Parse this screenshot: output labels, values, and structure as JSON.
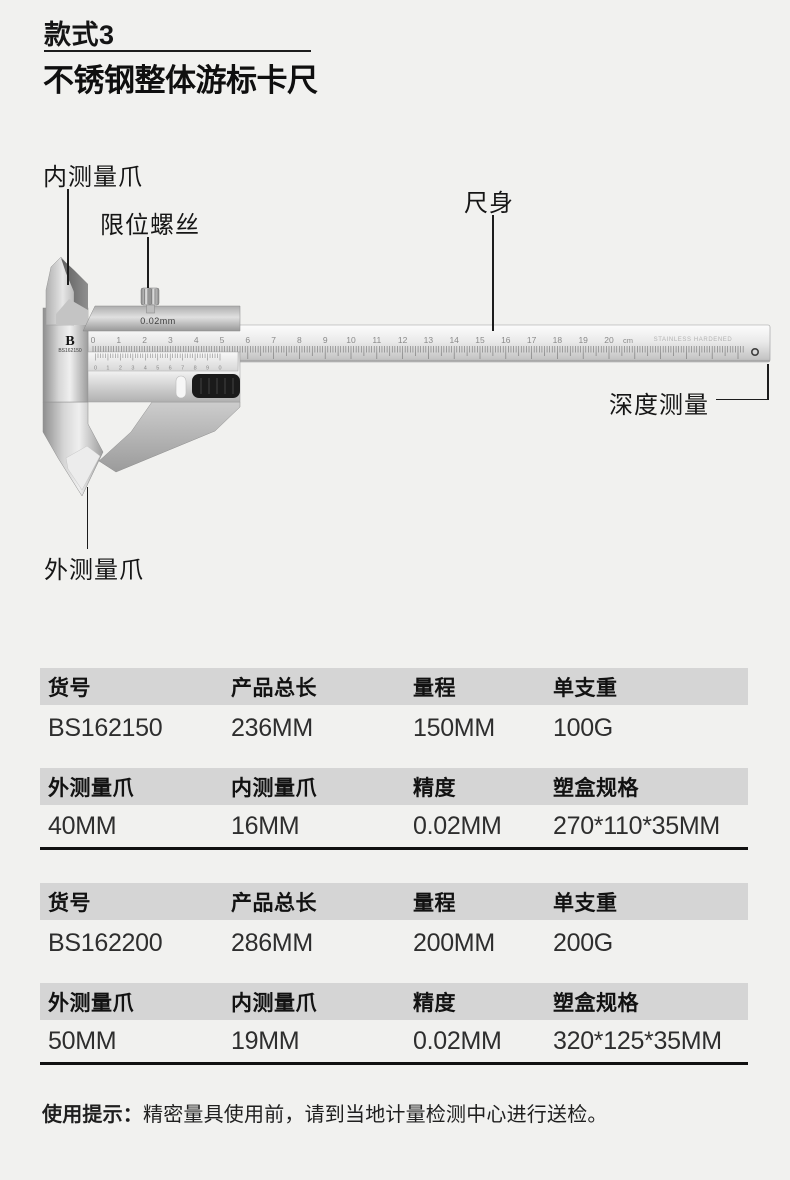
{
  "header": {
    "style_label": "款式3",
    "title": "不锈钢整体游标卡尺"
  },
  "diagram": {
    "callouts": [
      {
        "id": "inner-jaw",
        "label": "内测量爪"
      },
      {
        "id": "limit-screw",
        "label": "限位螺丝"
      },
      {
        "id": "beam",
        "label": "尺身"
      },
      {
        "id": "depth",
        "label": "深度测量"
      },
      {
        "id": "outer-jaw",
        "label": "外测量爪"
      }
    ],
    "caliper": {
      "vernier_label": "0.02mm",
      "logo": "B",
      "model": "BS162150",
      "scale_min": 0,
      "scale_max": 20,
      "scale_unit": "cm",
      "engraving": "STAINLESS  HARDENED",
      "vernier_digits": [
        "0",
        "1",
        "2",
        "3",
        "4",
        "5",
        "6",
        "7",
        "8",
        "9",
        "0"
      ]
    }
  },
  "tables": [
    {
      "sections": [
        {
          "headers": [
            "货号",
            "产品总长",
            "量程",
            "单支重"
          ],
          "values": [
            "BS162150",
            "236MM",
            "150MM",
            "100G"
          ]
        },
        {
          "headers": [
            "外测量爪",
            "内测量爪",
            "精度",
            "塑盒规格"
          ],
          "values": [
            "40MM",
            "16MM",
            "0.02MM",
            "270*110*35MM"
          ]
        }
      ]
    },
    {
      "sections": [
        {
          "headers": [
            "货号",
            "产品总长",
            "量程",
            "单支重"
          ],
          "values": [
            "BS162200",
            "286MM",
            "200MM",
            "200G"
          ]
        },
        {
          "headers": [
            "外测量爪",
            "内测量爪",
            "精度",
            "塑盒规格"
          ],
          "values": [
            "50MM",
            "19MM",
            "0.02MM",
            "320*125*35MM"
          ]
        }
      ]
    }
  ],
  "footer": {
    "note_prefix": "使用提示：",
    "note_body": "精密量具使用前，请到当地计量检测中心进行送检。"
  },
  "colors": {
    "page_bg": "#f1f1ef",
    "table_header_bg": "#d5d5d5",
    "rule_black": "#111111",
    "text_dark": "#1a1a1a"
  }
}
